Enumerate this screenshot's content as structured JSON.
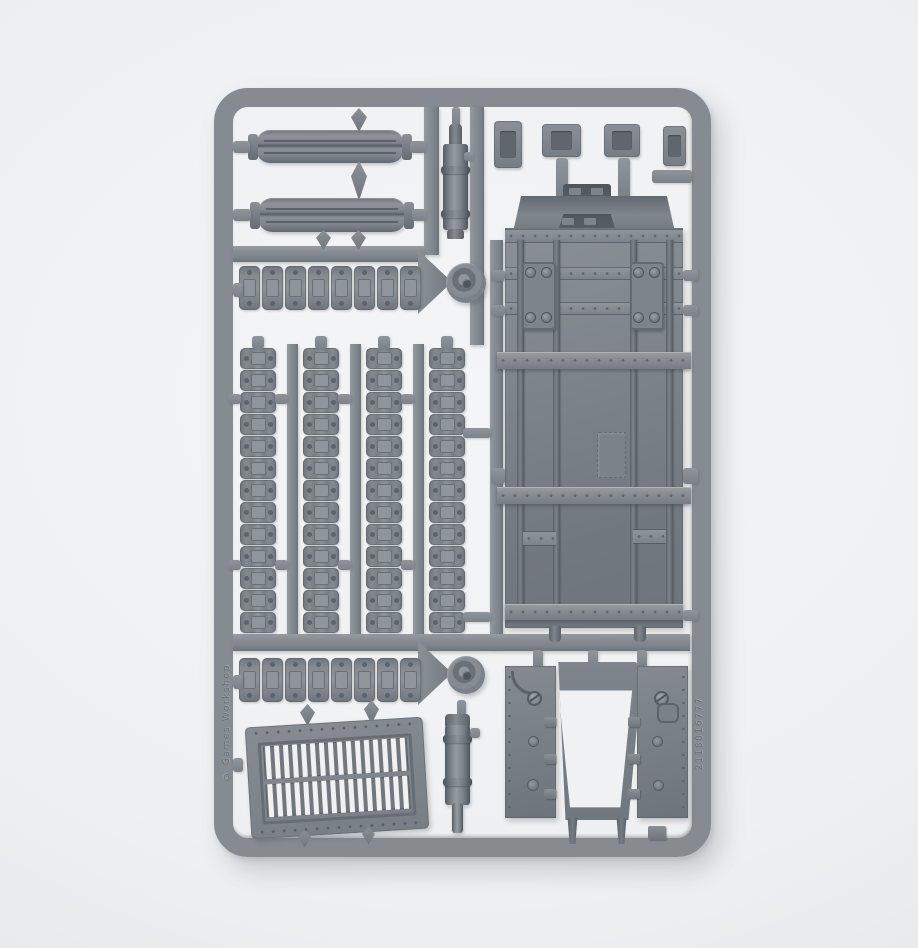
{
  "image": {
    "type": "photograph",
    "subject": "grey plastic model-kit sprue with tank parts on a light studio background"
  },
  "palette": {
    "background": "#eef0f2",
    "background_edge": "#e2e4e7",
    "plastic": "#858b91",
    "plastic_dark": "#5f656c",
    "plastic_deep": "#4c5258",
    "plastic_light": "#9ba0a6",
    "slot_white": "#eff1f3"
  },
  "sprue": {
    "embossed_left_text": "© Games Workshop",
    "embossed_right_text": "2118016777",
    "track_links_vertical": 13,
    "track_links_horizontal": 8,
    "vertical_track_runs": 4,
    "horizontal_track_runs": 2,
    "grille_slots_per_row": 16,
    "grille_rows": 2,
    "hull_panels": 1,
    "ramp_doors": 2,
    "exhaust_cylinders": 2,
    "road_wheel_hubs": 2,
    "small_brackets": 4,
    "track_guards": 2
  }
}
